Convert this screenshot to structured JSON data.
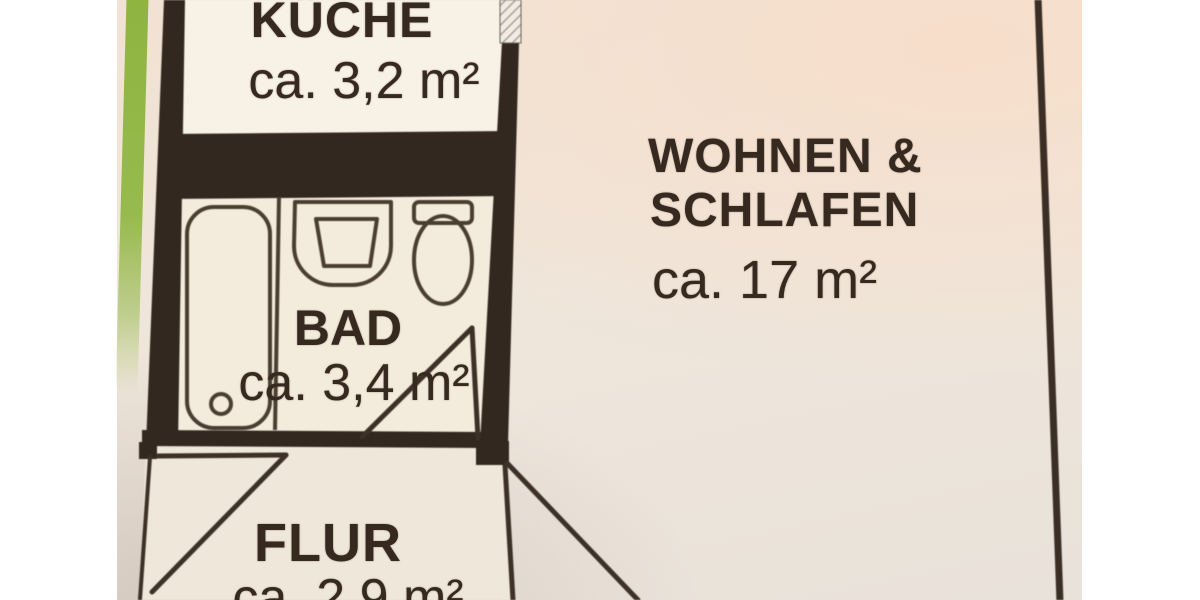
{
  "document": {
    "kind_label": "apartment floor plan photo"
  },
  "rooms": {
    "kitchen": {
      "label": "KÜCHE",
      "area": "ca. 3,2 m²"
    },
    "living_sleeping": {
      "label_line1": "WOHNEN &",
      "label_line2": "SCHLAFEN",
      "area": "ca. 17 m²"
    },
    "bathroom": {
      "label": "BAD",
      "area": "ca. 3,4 m²"
    },
    "hallway": {
      "label": "FLUR",
      "area": "ca. 2,9 m²"
    }
  },
  "fixtures": {
    "bathtub": "bathtub-icon",
    "washbasin": "washbasin-icon",
    "toilet": "toilet-icon"
  },
  "colors": {
    "margin_white": "#ffffff",
    "paper_cream": "#efe4d7",
    "wall_dark": "#33281f",
    "fixture_line": "#4a3e33",
    "text_dark": "#36291f",
    "stripe_green": "#8fb440"
  }
}
